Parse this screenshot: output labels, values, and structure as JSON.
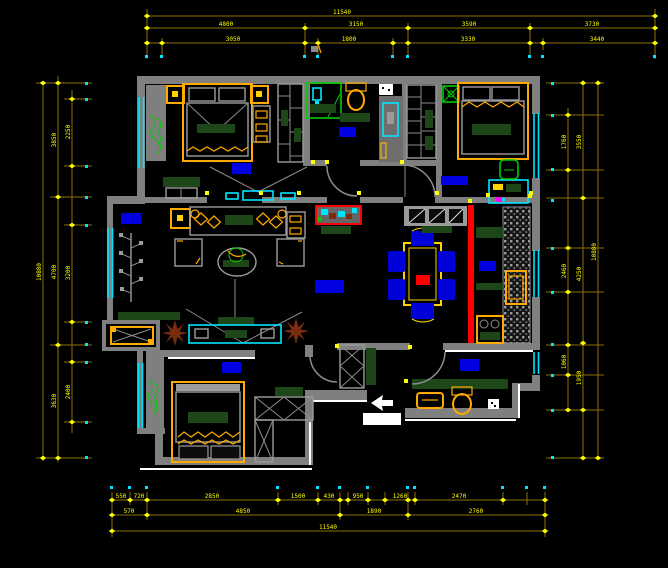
{
  "drawing": {
    "type": "residential-floor-plan",
    "background": "#000000"
  },
  "colors": {
    "wall": "#7f7f7f",
    "dimension_line": "#8a7000",
    "dimension_text": "#ffff00",
    "window": "#00e5ff",
    "room_label_highlight": "#0000e0",
    "furniture_accent": "#ffaa00",
    "table_accent": "#ffd400",
    "plant_green": "#00cc00",
    "counter_green": "#1d4719",
    "alert_red": "#ff0000",
    "plant_pot_brown": "#7a2d0e",
    "white_edge": "#ffffff",
    "magenta_marker": "#ff00ff"
  },
  "dims": {
    "top": {
      "total": "11540",
      "row2": [
        "4800",
        "3150",
        "3590",
        "3730"
      ],
      "row3": [
        "3050",
        "1800",
        "3330",
        "3440"
      ]
    },
    "bottom": {
      "row1": [
        "550",
        "720",
        "2850",
        "1500",
        "430",
        "950",
        "1260",
        "2470"
      ],
      "row2": [
        "570",
        "4850",
        "1890",
        "2760"
      ],
      "total": "11540"
    },
    "left": {
      "outer": "10880",
      "mid": [
        "3850",
        "4700",
        "3630"
      ],
      "inner": [
        "2250",
        "3200",
        "2400"
      ]
    },
    "right": {
      "outer": "10880",
      "mid": [
        "3550",
        "4250",
        "1950"
      ],
      "inner": [
        "1760",
        "2460",
        "1060"
      ]
    }
  }
}
